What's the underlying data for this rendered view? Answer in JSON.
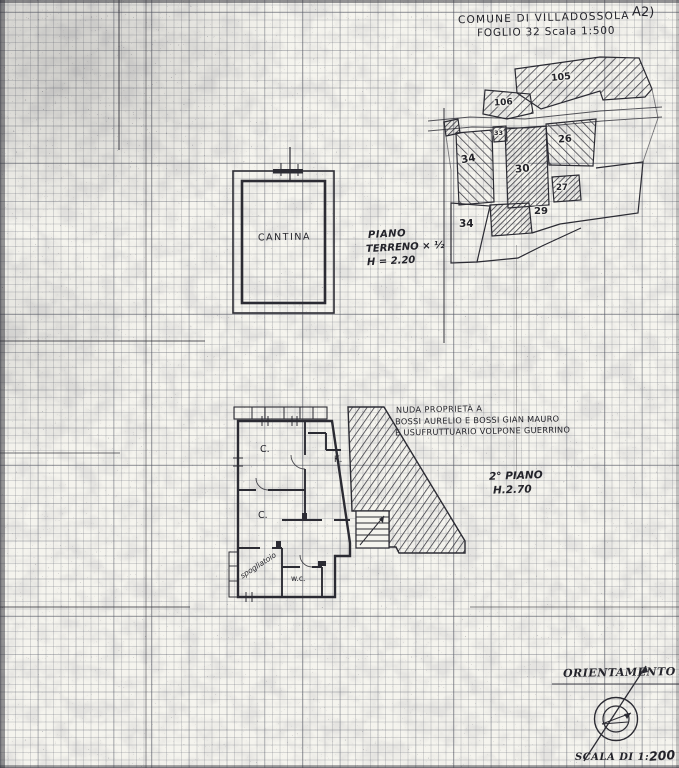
{
  "sheet": {
    "corner_label": "A2)",
    "title_line1": "COMUNE DI VILLADOSSOLA",
    "title_line2": "FOGLIO 32 Scala 1:500"
  },
  "map": {
    "parcels": {
      "p105": "105",
      "p106": "106",
      "p33": "33",
      "p34": "34",
      "p30": "30",
      "p26": "26",
      "p27": "27",
      "p29": "29",
      "p34b": "34"
    }
  },
  "ground_floor": {
    "room": "CANTINA",
    "caption1": "PIANO",
    "caption2": "TERRENO × ½",
    "caption3": "H = 2.20"
  },
  "second_floor": {
    "ownership1": "NUDA PROPRIETÀ A",
    "ownership2": "BOSSI AURELIO E BOSSI GIAN MAURO",
    "ownership3": "E USUFRUTTUARIO VOLPONE GUERRINO",
    "caption1": "2° PIANO",
    "caption2": "H.2.70",
    "rooms": {
      "c1": "C.",
      "k": "K.",
      "c2": "C.",
      "spogliatoio": "spogliatoio",
      "wc": "w.c."
    }
  },
  "footer": {
    "orientation": "ORIENTAMENTO",
    "scale_prefix": "SCALA DI 1:",
    "scale_value": "200"
  },
  "colors": {
    "ink": "#2b2b33",
    "paper": "#f5f4ee"
  }
}
